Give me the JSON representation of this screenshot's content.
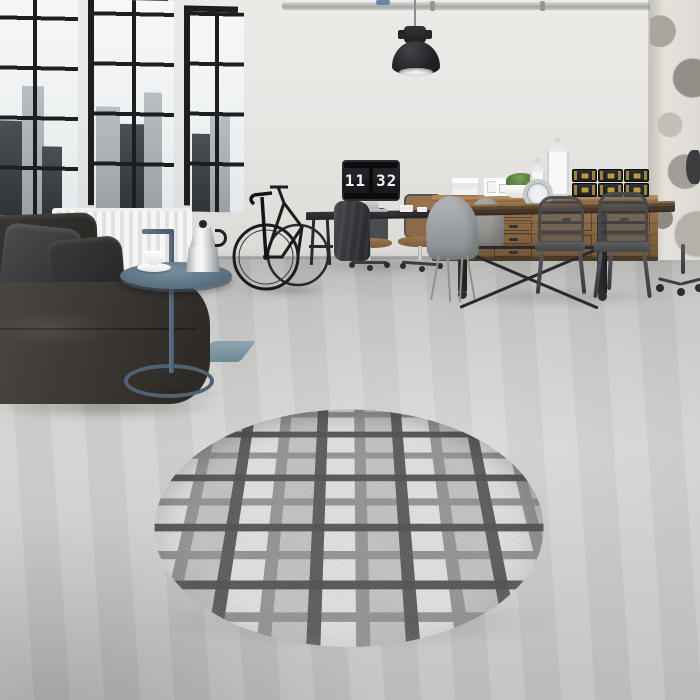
{
  "meta": {
    "scene_label": "industrial-loft-interior-with-round-plaid-rug"
  },
  "monitor": {
    "hours": "11",
    "minutes": "32"
  },
  "scene_objects": [
    "factory-windows",
    "city-skyline",
    "radiator",
    "leather-sofa",
    "dark-pillows",
    "steel-blue-side-table",
    "moka-pot",
    "coffee-cup",
    "bicycle",
    "pendant-lamp",
    "ceiling-conduit",
    "computer-desk",
    "flip-clock-monitor",
    "office-chairs",
    "draped-jacket",
    "wood-sideboard",
    "storage-trunks",
    "picture-frames",
    "potted-moss-plant",
    "white-lanterns",
    "ornate-table-clock",
    "dining-table",
    "shell-chairs",
    "metal-armchairs",
    "rolling-caster-base",
    "distressed-wall-column",
    "teal-door-mat",
    "round-plaid-rug"
  ],
  "colors": {
    "wall": "#e7e6e3",
    "frame-black": "#1d1e20",
    "wood-light": "#a07a50",
    "brass": "#b99a3e",
    "rug-base": "#969694",
    "rug-light": "#cfcfcd",
    "rug-dark": "#6d6d6b",
    "steel-blue": "#5e7382",
    "sofa-leather": "#3b3732",
    "metal-chair": "#55575a",
    "floor-gray": "#cbccca"
  }
}
